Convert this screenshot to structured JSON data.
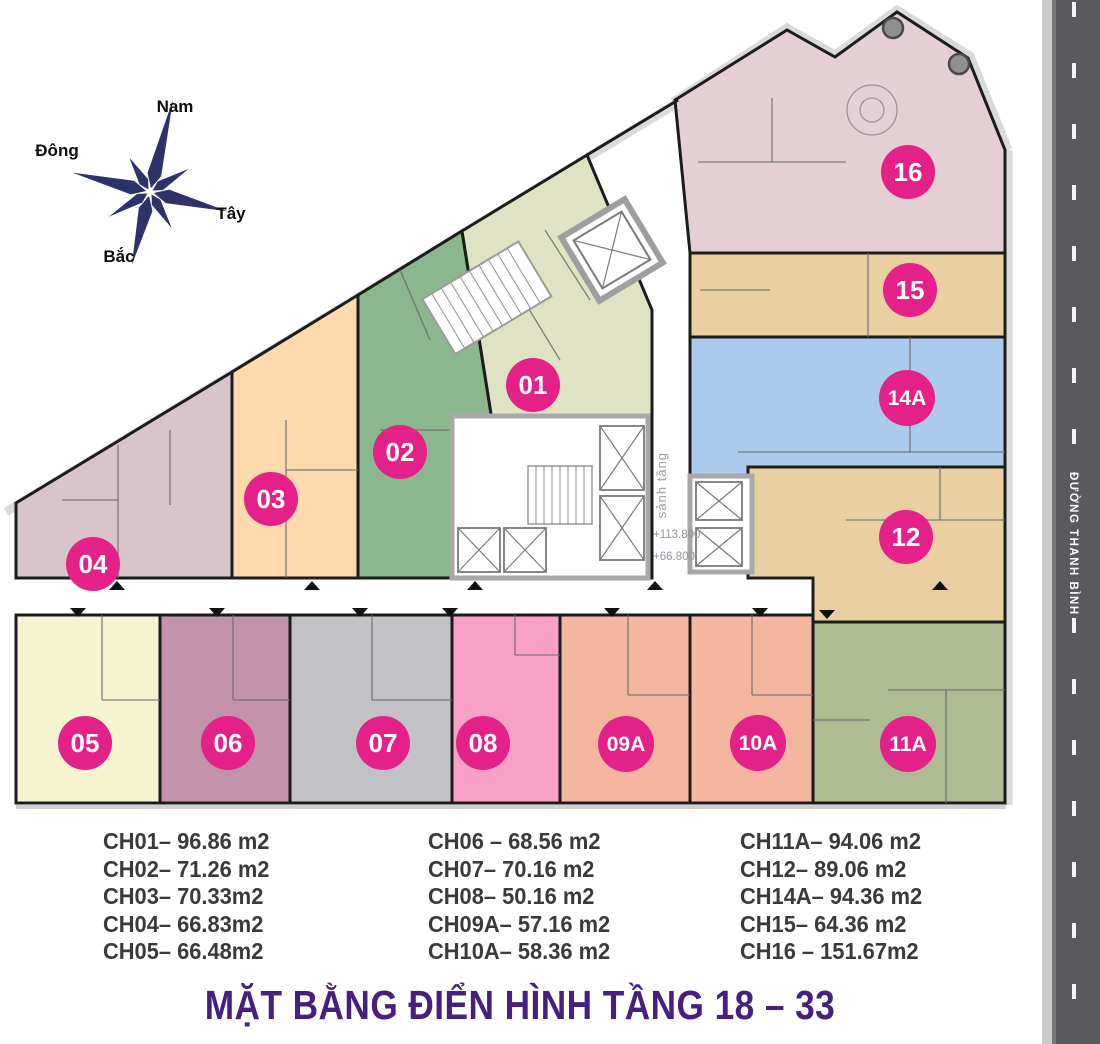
{
  "compass": {
    "top": "Nam",
    "left": "Đông",
    "right": "Tây",
    "bottom": "Bắc",
    "color": "#2d3268"
  },
  "road": {
    "name": "ĐƯỜNG THANH BÌNH",
    "asphalt_color": "#5a595e",
    "line_color": "#f5f5f5"
  },
  "plan": {
    "badge_color": "#e42188",
    "wall_color": "#1c1c1c",
    "core": {
      "lobby_label": "sảnh tầng",
      "level_upper": "+113.800",
      "level_lower": "+66.800"
    },
    "units": [
      {
        "id": "01",
        "color": "#e0e3c3"
      },
      {
        "id": "02",
        "color": "#8cb68d"
      },
      {
        "id": "03",
        "color": "#fbdaae"
      },
      {
        "id": "04",
        "color": "#d9c4cc"
      },
      {
        "id": "05",
        "color": "#f6f4d0"
      },
      {
        "id": "06",
        "color": "#c292ab"
      },
      {
        "id": "07",
        "color": "#c2c1c5"
      },
      {
        "id": "08",
        "color": "#f8a0c6"
      },
      {
        "id": "09A",
        "color": "#f4b69e"
      },
      {
        "id": "10A",
        "color": "#f4b69e"
      },
      {
        "id": "11A",
        "color": "#aeba91"
      },
      {
        "id": "12",
        "color": "#ead0a0"
      },
      {
        "id": "14A",
        "color": "#accbec"
      },
      {
        "id": "15",
        "color": "#ead0a0"
      },
      {
        "id": "16",
        "color": "#e4cfd5"
      }
    ]
  },
  "legend": {
    "text_color": "#3a3a3a",
    "columns": [
      [
        "CH01– 96.86 m2",
        "CH02– 71.26 m2",
        "CH03– 70.33m2",
        "CH04– 66.83m2",
        "CH05– 66.48m2"
      ],
      [
        "CH06 – 68.56 m2",
        "CH07– 70.16 m2",
        "CH08– 50.16 m2",
        "CH09A– 57.16 m2",
        "CH10A– 58.36 m2"
      ],
      [
        "CH11A– 94.06 m2",
        "CH12– 89.06 m2",
        "CH14A– 94.36 m2",
        "CH15– 64.36 m2",
        "CH16 – 151.67m2"
      ]
    ]
  },
  "title": {
    "text": "MẶT BẰNG ĐIỂN HÌNH TẦNG 18 – 33",
    "color": "#45207e"
  }
}
